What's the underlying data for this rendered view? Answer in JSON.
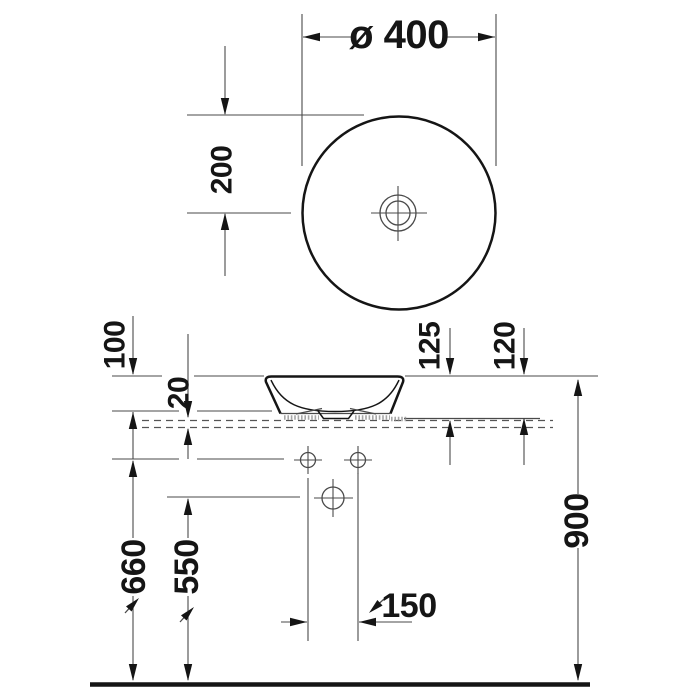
{
  "colors": {
    "line": "#4a4a4a",
    "bold": "#151515",
    "dashed": "#555555",
    "background": "#ffffff"
  },
  "top_view": {
    "diameter_label": "ø 400",
    "center_distance_label": "200"
  },
  "side_view": {
    "labels": {
      "protrusion_above_console": "100",
      "console_panel_thickness": "20",
      "recess_depth": "125",
      "basin_height": "120",
      "supply_connection_height": "660",
      "drain_height": "550",
      "supply_spacing": "150",
      "rim_height": "900"
    }
  }
}
